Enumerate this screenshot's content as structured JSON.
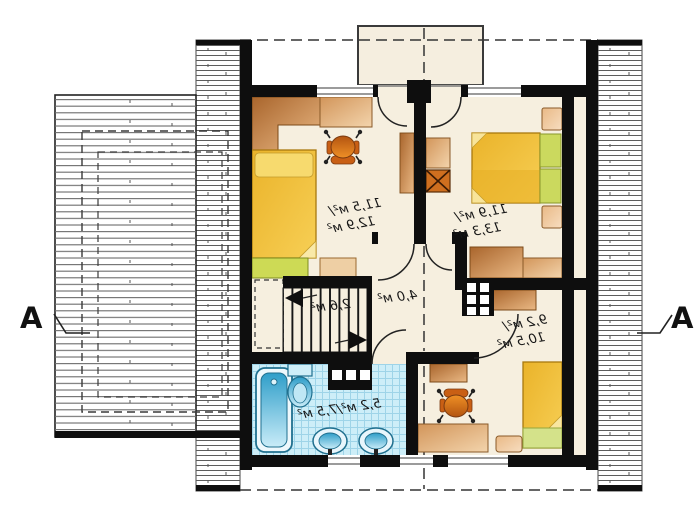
{
  "plan": {
    "type": "floor-plan-upper-storey-mirrored",
    "section_label": "A",
    "rooms": [
      {
        "name": "bedroom-top-left",
        "line1": "11,5 м²/",
        "line2": "12,9 м²"
      },
      {
        "name": "bedroom-top-right",
        "line1": "11,9 м²/",
        "line2": "13,3 м²"
      },
      {
        "name": "bedroom-bottom-right",
        "line1": "9,2 м²/",
        "line2": "10,5 м²"
      },
      {
        "name": "bathroom",
        "label": "5,2 м²/7,5 м²"
      },
      {
        "name": "hall",
        "label": "4,0 м²"
      },
      {
        "name": "stairs",
        "label": "2,6 м²"
      }
    ],
    "colors": {
      "wall": "#0e0e0e",
      "floor": "#f6efdf",
      "tile": "#cdeef8",
      "tile_grid": "#9ed4e8",
      "bed_yellow": "#f0bd38",
      "blanket_green": "#cbd95e",
      "wood_brown": "#c98a4e",
      "chair_orange": "#e07a1f",
      "fixture_blue": "#39a8d8",
      "hatch_gray": "#606060"
    }
  }
}
